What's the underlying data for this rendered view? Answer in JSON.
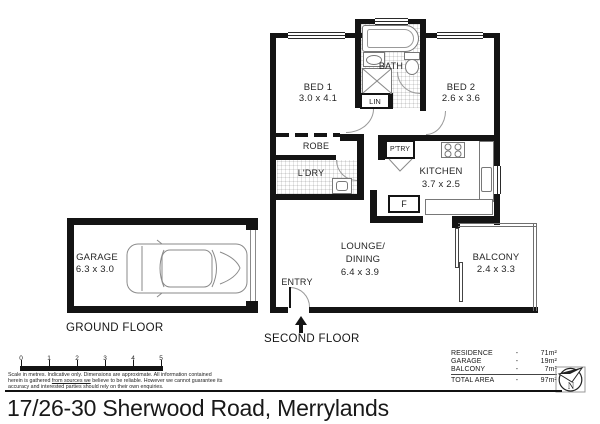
{
  "title": "17/26-30 Sherwood Road, Merrylands",
  "floors": {
    "second": "SECOND FLOOR",
    "ground": "GROUND FLOOR"
  },
  "rooms": {
    "bed1": {
      "name": "BED 1",
      "dims": "3.0 x 4.1"
    },
    "bed2": {
      "name": "BED 2",
      "dims": "2.6 x 3.6"
    },
    "bath": {
      "name": "BATH"
    },
    "lin": {
      "name": "LIN"
    },
    "robe": {
      "name": "ROBE"
    },
    "laundry": {
      "name": "L'DRY"
    },
    "pantry": {
      "name": "P'TRY"
    },
    "kitchen": {
      "name": "KITCHEN",
      "dims": "3.7 x 2.5"
    },
    "fridge": {
      "name": "F"
    },
    "lounge": {
      "name_line1": "LOUNGE/",
      "name_line2": "DINING",
      "dims": "6.4 x 3.9"
    },
    "balcony": {
      "name": "BALCONY",
      "dims": "2.4 x 3.3"
    },
    "garage": {
      "name": "GARAGE",
      "dims": "6.3 x 3.0"
    },
    "entry": {
      "name": "ENTRY"
    }
  },
  "scale_bar": {
    "labels": [
      "0",
      "1",
      "2",
      "3",
      "4",
      "5"
    ]
  },
  "disclaimer": {
    "line1": "Scale in metres. Indicative only. Dimensions are approximate. All information contained",
    "line2_pre": "herein is gathered ",
    "line2_underlined": "from sources we",
    "line2_post": " believe to be reliable. However we cannot guarantee its",
    "line3": "accuracy and interested parties should rely on their own enquiries."
  },
  "area_table": {
    "separator": "-",
    "rows": [
      {
        "label": "RESIDENCE",
        "value": "71m²"
      },
      {
        "label": "GARAGE",
        "value": "19m²"
      },
      {
        "label": "BALCONY",
        "value": "7m²"
      },
      {
        "label": "TOTAL AREA",
        "value": "97m²"
      }
    ]
  },
  "compass": {
    "label": "N"
  },
  "colors": {
    "wall": "#141414",
    "line": "#787878",
    "text": "#1a1a1a"
  }
}
